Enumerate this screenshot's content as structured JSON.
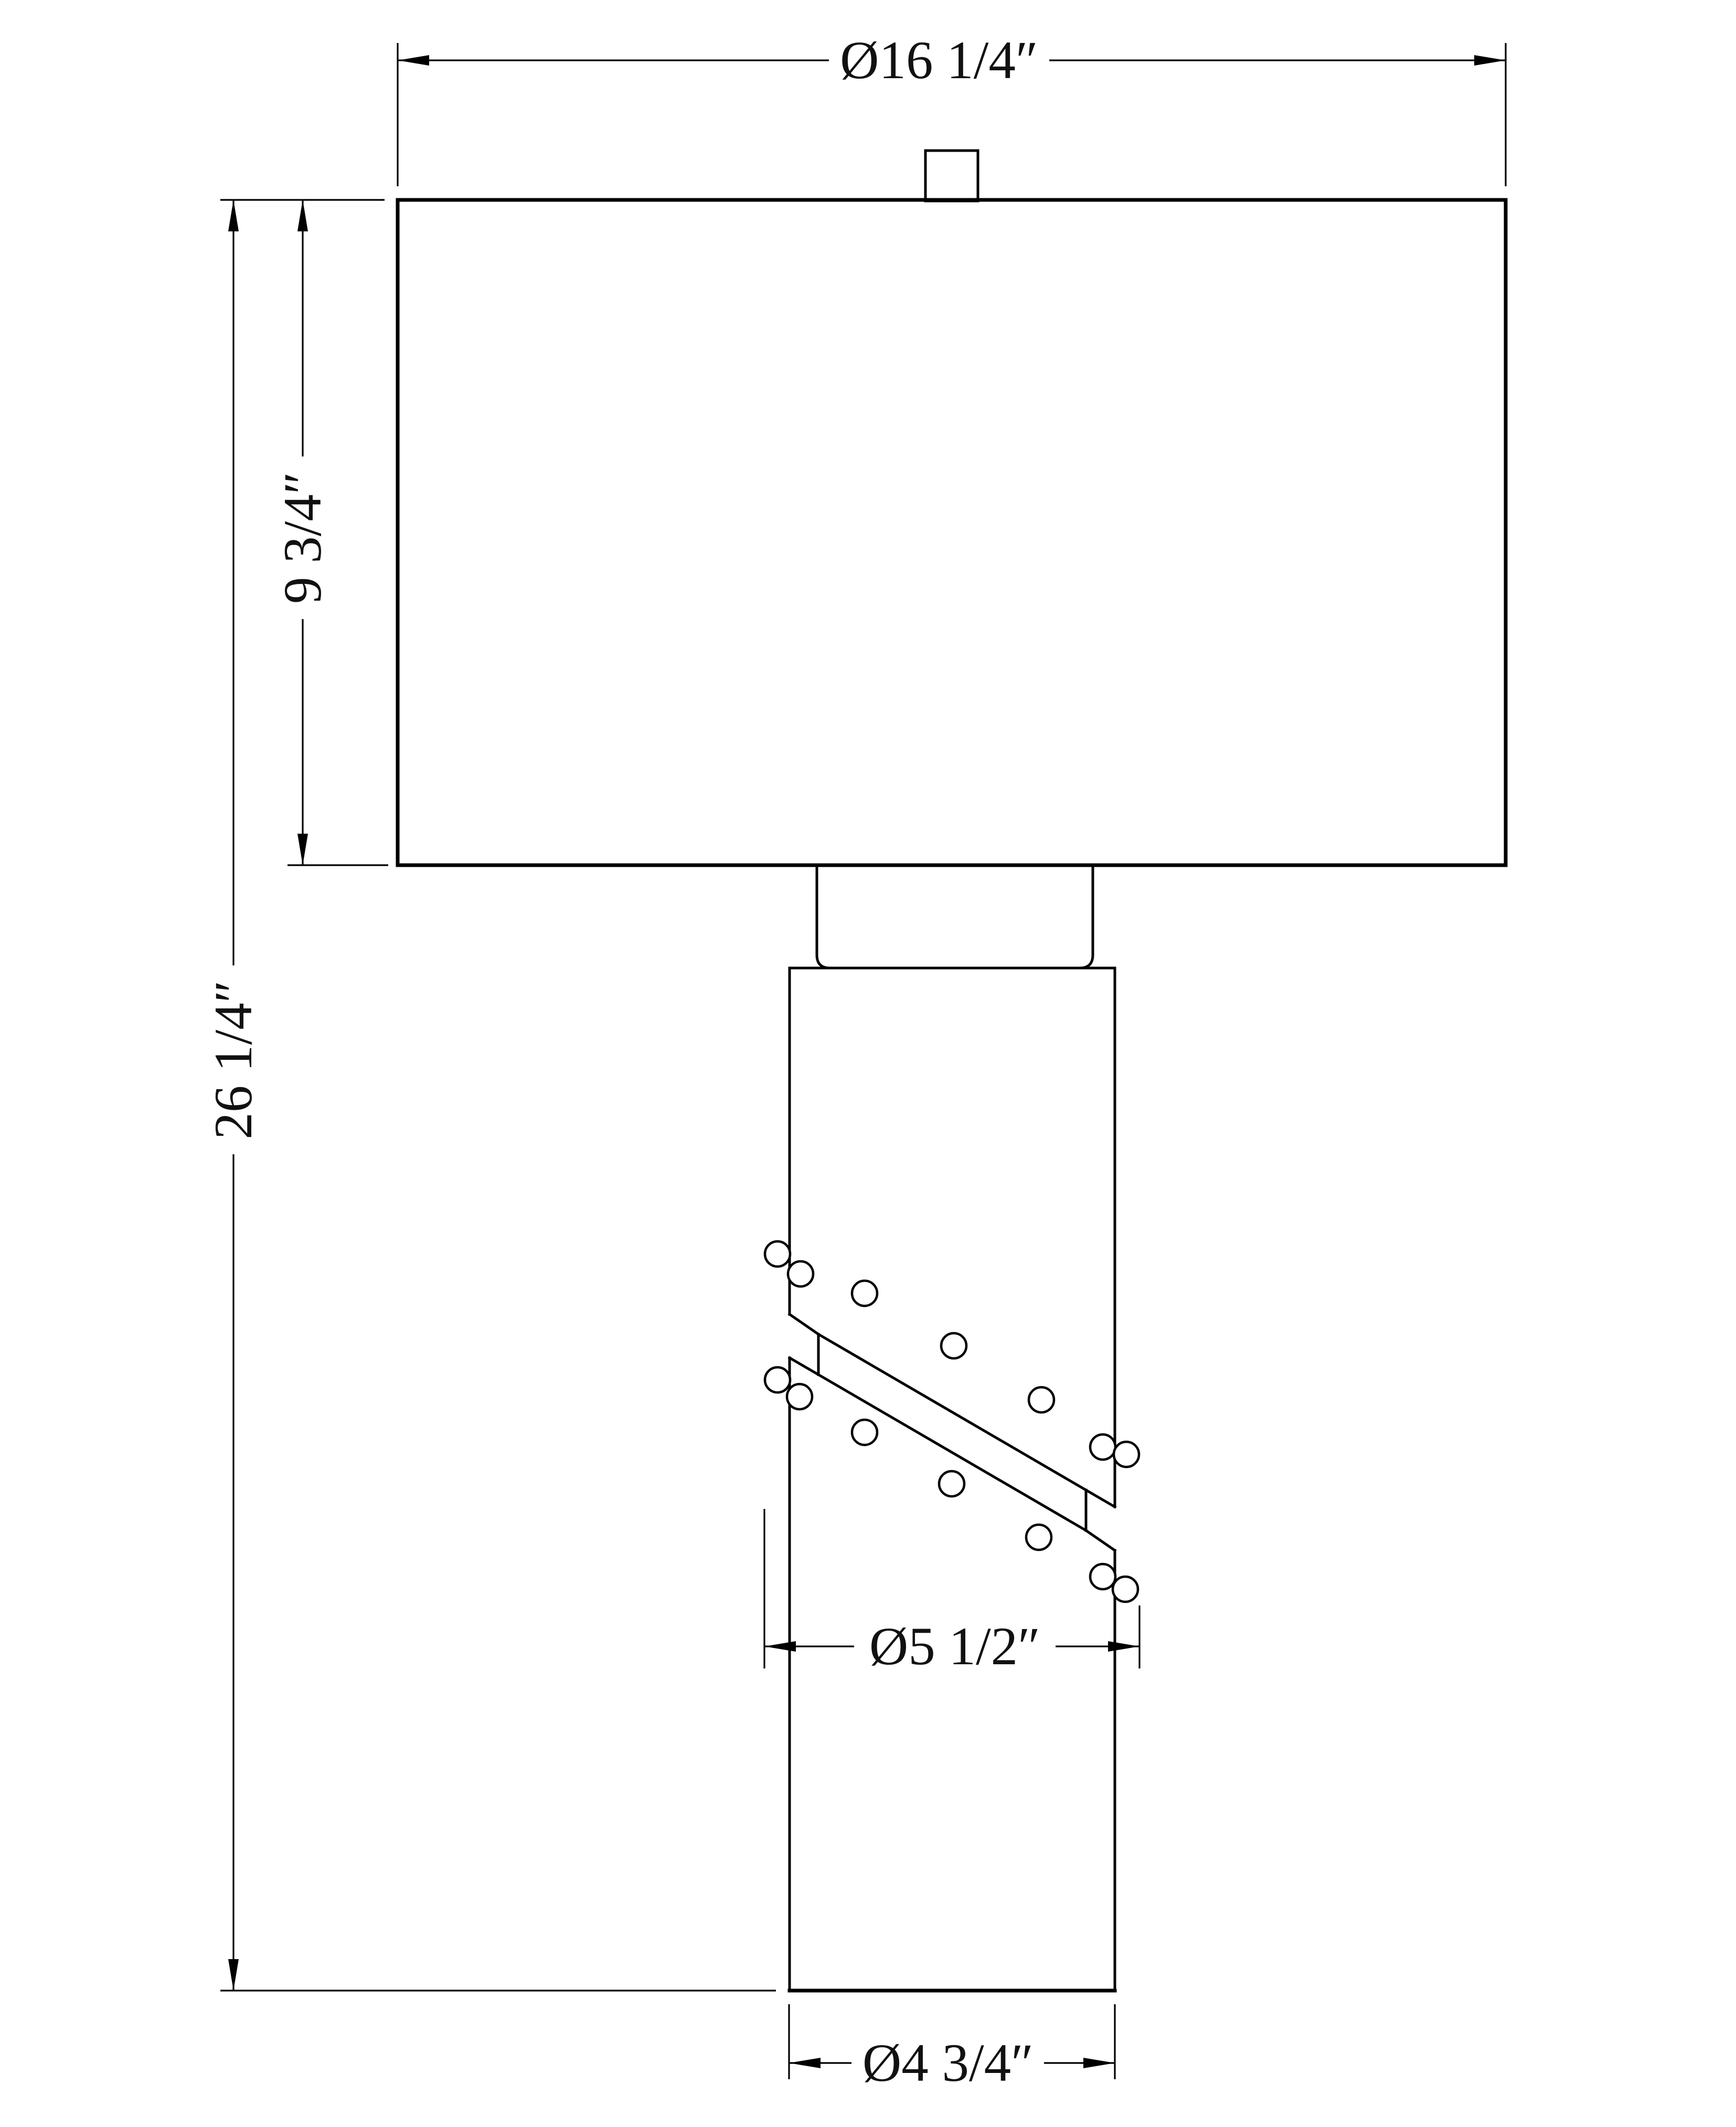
{
  "page": {
    "background": "#ffffff",
    "ink": "#000000",
    "kind": "technical dimension drawing",
    "subject": "table lamp front elevation"
  },
  "dimensions": {
    "shade_diameter": {
      "label": "Ø16 1/4″",
      "value": 16.25
    },
    "shade_height": {
      "label": "9 3/4″",
      "value": 9.75
    },
    "total_height": {
      "label": "26 1/4″",
      "value": 26.25
    },
    "band_diameter": {
      "label": "Ø5 1/2″",
      "value": 5.5
    },
    "base_diameter": {
      "label": "Ø4 3/4″",
      "value": 4.75
    },
    "units": "inches"
  }
}
